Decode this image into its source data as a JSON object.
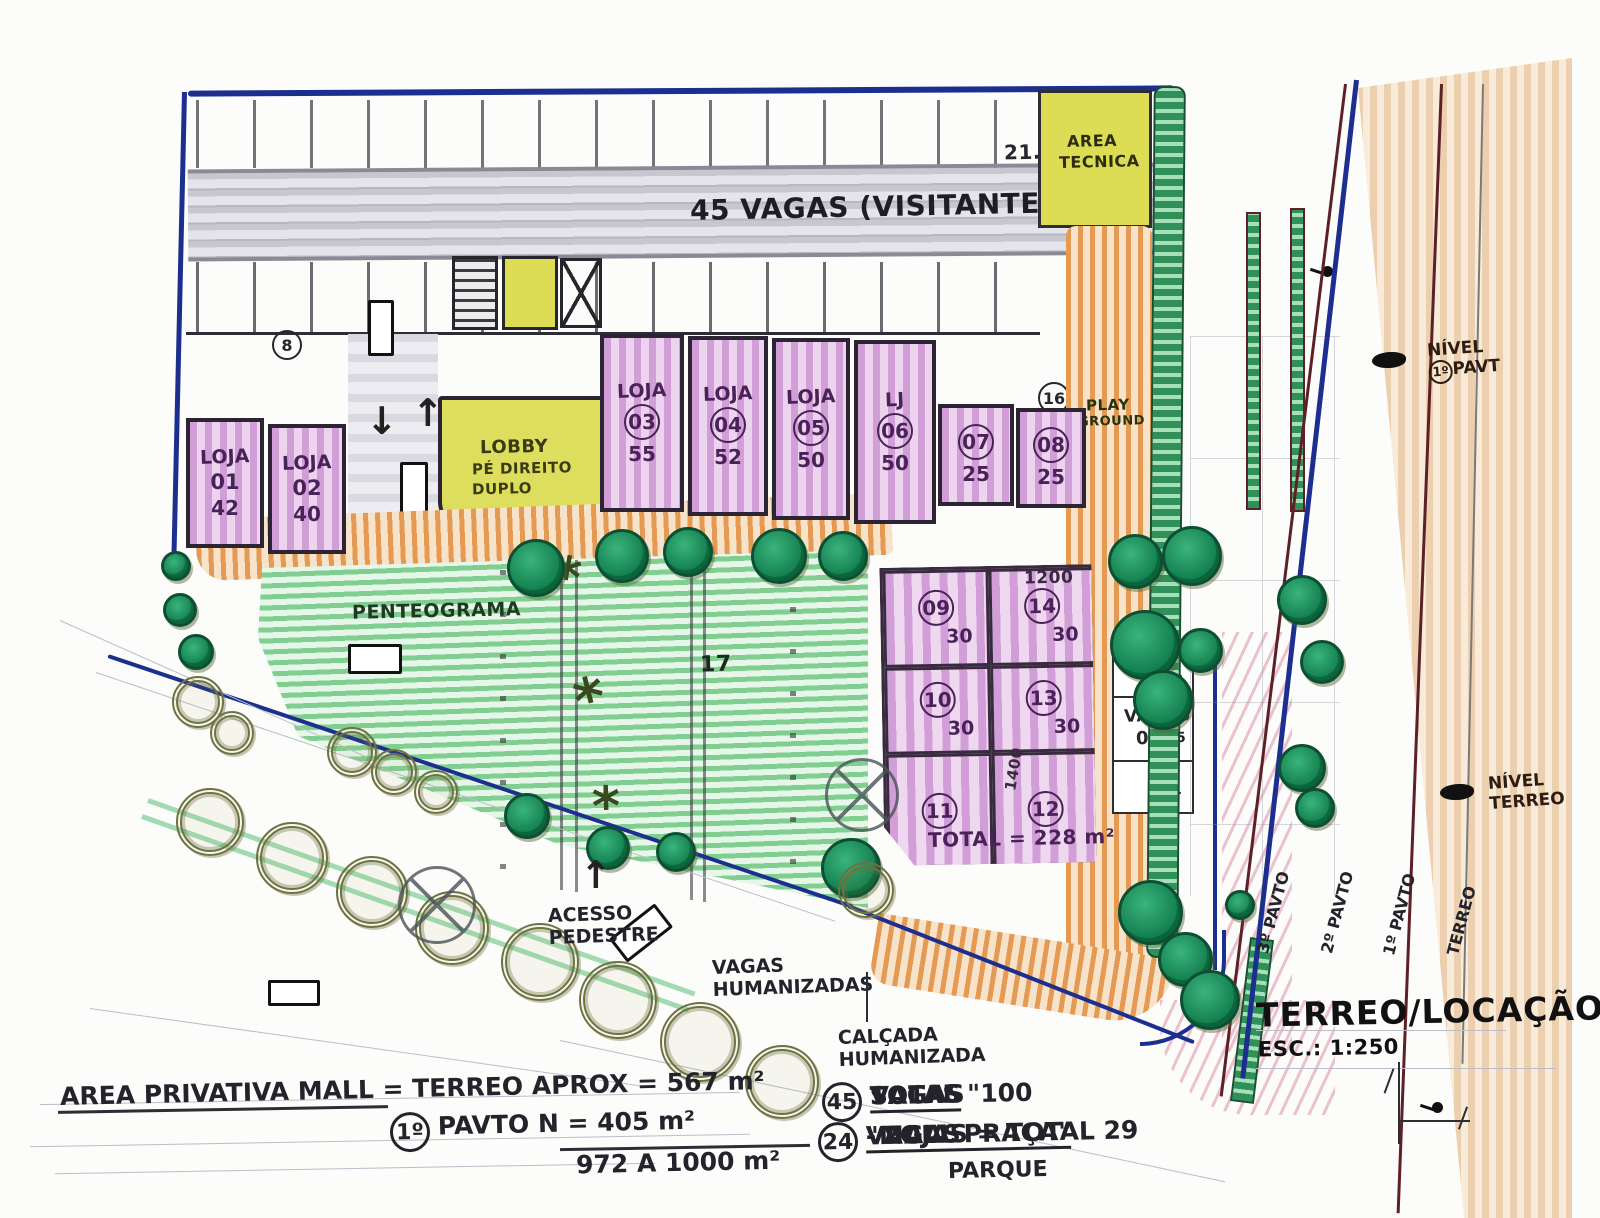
{
  "garage": {
    "vagas_label": "45 VAGAS (VISITANTES)",
    "note_21": "21.",
    "bay_8": "8",
    "bay_16": "16",
    "area_tecnica_l1": "AREA",
    "area_tecnica_l2": "TECNICA"
  },
  "lobby": {
    "l1": "LOBBY",
    "l2": "PÉ DIREITO",
    "l3": "DUPLO"
  },
  "play": {
    "l1": "PLAY",
    "l2": "GROUND"
  },
  "shops": [
    {
      "name": "LOJA",
      "num": "01",
      "area": "42"
    },
    {
      "name": "LOJA",
      "num": "02",
      "area": "40"
    },
    {
      "name": "LOJA",
      "num": "03",
      "area": "55"
    },
    {
      "name": "LOJA",
      "num": "04",
      "area": "52"
    },
    {
      "name": "LOJA",
      "num": "05",
      "area": "50"
    },
    {
      "name": "LJ",
      "num": "06",
      "area": "50"
    },
    {
      "name": "",
      "num": "07",
      "area": "25"
    },
    {
      "name": "",
      "num": "08",
      "area": "25"
    }
  ],
  "block": {
    "units": [
      {
        "num": "09",
        "area": "30"
      },
      {
        "num": "14",
        "area": "30"
      },
      {
        "num": "10",
        "area": "30"
      },
      {
        "num": "13",
        "area": "30"
      },
      {
        "num": "11",
        "area": ""
      },
      {
        "num": "12",
        "area": ""
      }
    ],
    "dim_top": "1200",
    "dim_side": "1400",
    "total": "TOTAL = 228 m²"
  },
  "vagas06": {
    "l1": "VAGAS",
    "l2": "06",
    "n1": "6",
    "n2": "5",
    "n3": "4"
  },
  "green": {
    "label": "PENTEOGRAMA",
    "count": "17"
  },
  "notes": {
    "acesso_l1": "ACESSO",
    "acesso_l2": "PEDESTRE",
    "vh_l1": "VAGAS",
    "vh_l2": "HUMANIZADAS",
    "ch_l1": "CALÇADA",
    "ch_l2": "HUMANIZADA"
  },
  "levels": {
    "n1_a": "NÍVEL",
    "n1_circle": "1º",
    "n1_b": "PAVT",
    "n2_a": "NÍVEL",
    "n2_b": "TERREO",
    "cols": [
      "3º PAVTO",
      "2º PAVTO",
      "1º PAVTO",
      "TERREO"
    ]
  },
  "titleblock": {
    "title": "TERREO/LOCAÇÃO",
    "scale": "ESC.: 1:250"
  },
  "summary": {
    "l1": "AREA PRIVATIVA MALL = TERREO APROX = 567 m²",
    "l2_circle": "1º",
    "l2": "PAVTO N  = 405 m²",
    "l3": "972 A 1000 m²",
    "r1_circle": "45",
    "r1a": "VAGAS",
    "r1b": "SALAS",
    "r1c": "TOTAL \"100",
    "r2_circle": "24",
    "r2a": "VAGAS",
    "r2b": "\"MALL PRAÇA\"",
    "r2c": "- LOJAS = TOTAL 29",
    "r3": "PARQUE"
  },
  "colors": {
    "boundary_blue": "#1d2f8e",
    "shop_purple": "#d29ed8",
    "walkway_orange": "#e59a54",
    "parking_green": "#80cf90",
    "tech_yellow": "#dcdc55",
    "road_tan": "#eccfae",
    "tree_green": "#107a4b",
    "road_red": "#5c2026"
  }
}
